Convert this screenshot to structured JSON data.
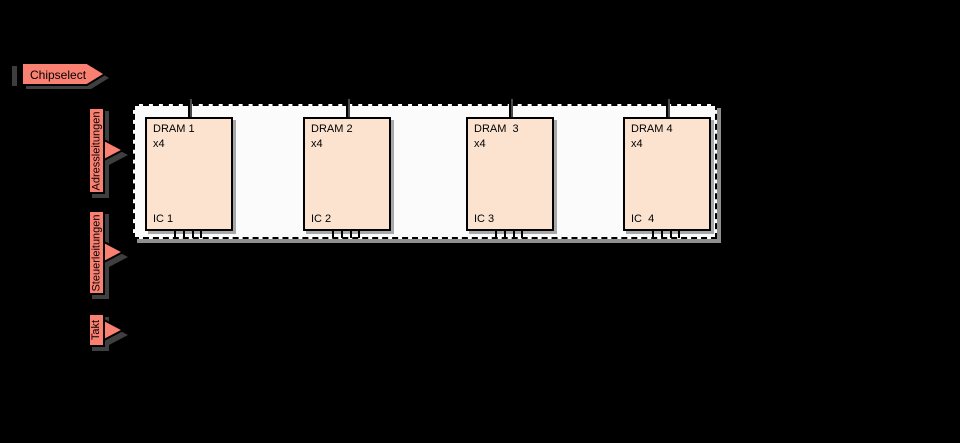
{
  "diagram": {
    "title_semantic": "DRAM module wiring diagram",
    "signals": {
      "chipselect": "Chipselect",
      "address": "Adressleitungen",
      "control": "Steuerleitungen",
      "clock": "Takt"
    },
    "module": {
      "chips": [
        {
          "title": "DRAM 1",
          "width_label": "x4",
          "ic_label": "IC 1"
        },
        {
          "title": "DRAM 2",
          "width_label": "x4",
          "ic_label": "IC 2"
        },
        {
          "title": "DRAM  3",
          "width_label": "x4",
          "ic_label": "IC 3"
        },
        {
          "title": "DRAM 4",
          "width_label": "x4",
          "ic_label": "IC  4"
        }
      ],
      "pins_per_chip": 4
    },
    "colors": {
      "background": "#000000",
      "signal_label_fill": "#fa8072",
      "chip_fill": "#fce3d0",
      "module_fill": "#fbfbfb",
      "outline": "#000000",
      "shadow_dark": "#3f3f3f",
      "shadow_light": "#8f8f8f"
    }
  }
}
